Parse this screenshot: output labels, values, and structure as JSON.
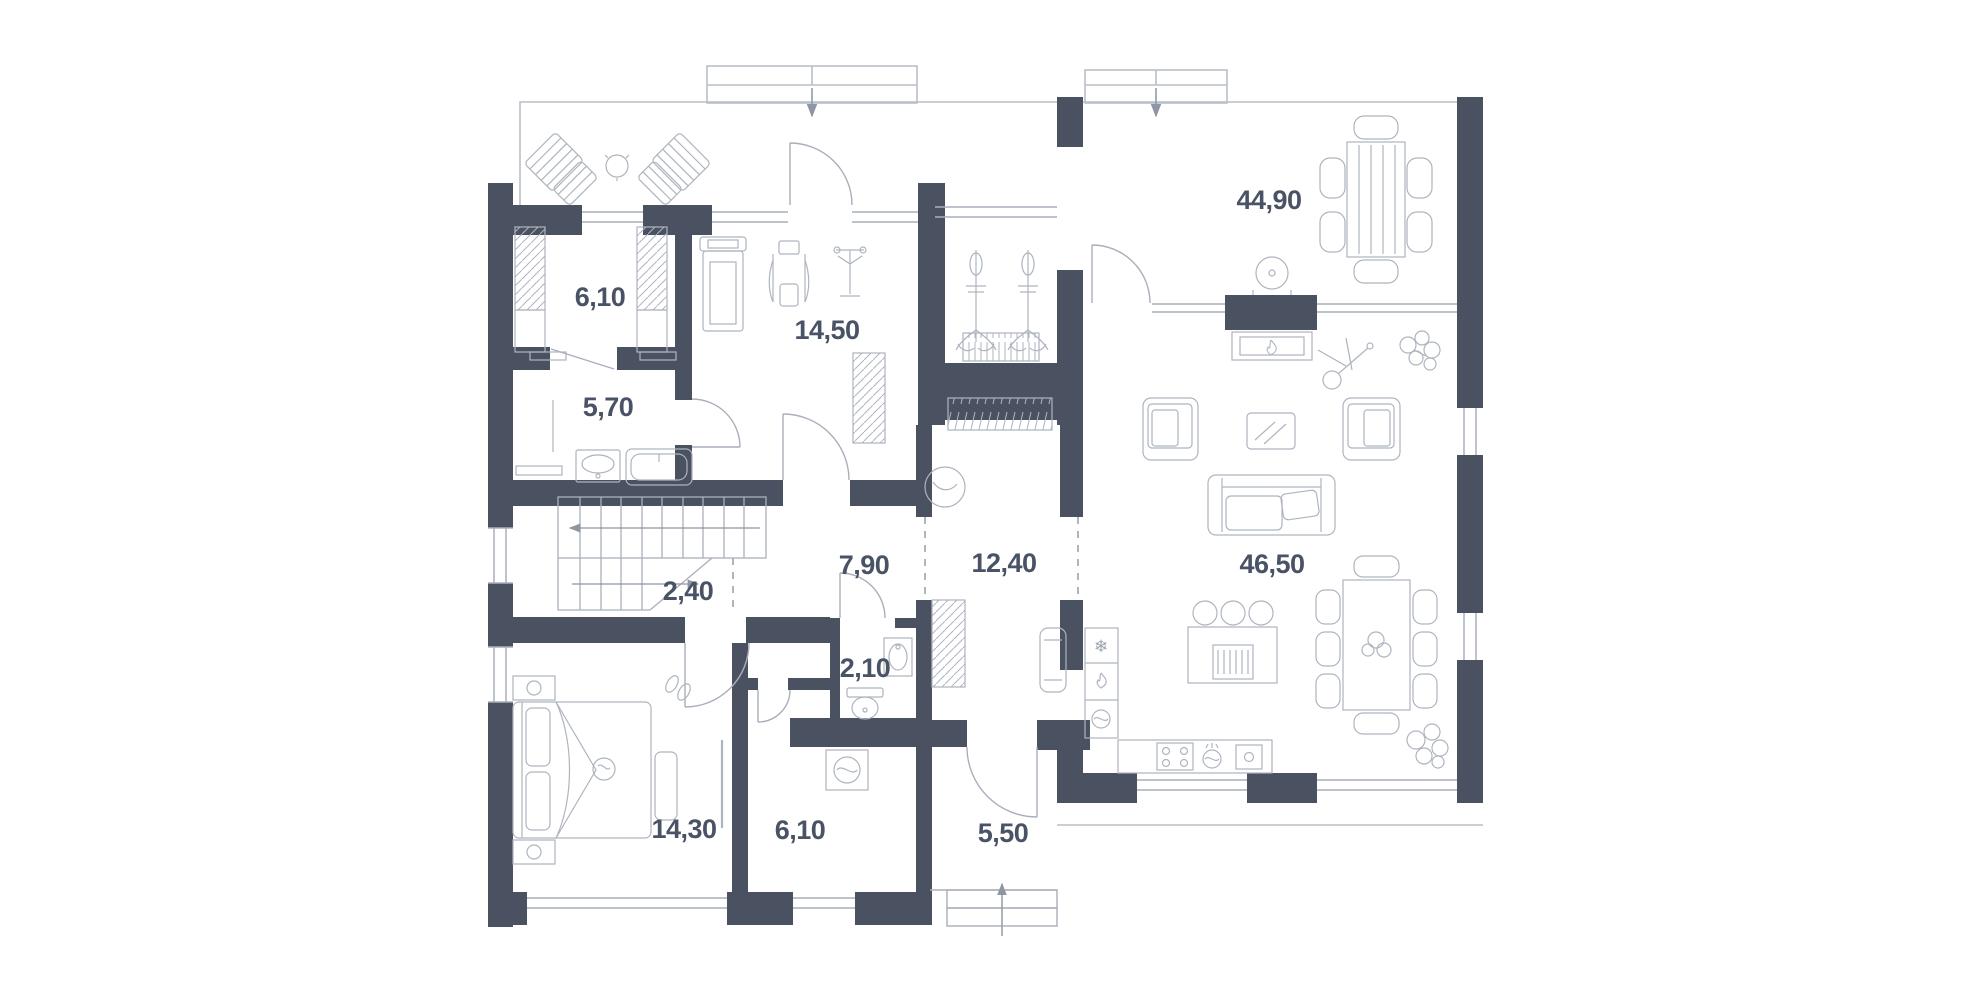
{
  "document": {
    "type": "floor-plan-drawing",
    "units": "square-meters-with-comma-decimal"
  },
  "colors": {
    "background": "#FFFFFF",
    "wall": "#4A5160",
    "furniture_line": "#A9AFBA",
    "outline_light": "#B9BEC7",
    "label_text": "#4A5365",
    "dash_line": "#8E95A3"
  },
  "floor_plan": {
    "rooms": [
      {
        "id": "dressing-top",
        "area": "6,10"
      },
      {
        "id": "gym",
        "area": "14,50"
      },
      {
        "id": "bathroom-upper",
        "area": "5,70"
      },
      {
        "id": "great-room",
        "area": "44,90"
      },
      {
        "id": "stair-hall",
        "area": "2,40"
      },
      {
        "id": "hall",
        "area": "7,90"
      },
      {
        "id": "corridor",
        "area": "12,40"
      },
      {
        "id": "living-kitchen",
        "area": "46,50"
      },
      {
        "id": "bedroom",
        "area": "14,30"
      },
      {
        "id": "wc",
        "area": "2,10"
      },
      {
        "id": "bathroom-lower",
        "area": "6,10"
      },
      {
        "id": "entry",
        "area": "5,50"
      }
    ],
    "icons": {
      "snowflake": "❄"
    }
  }
}
